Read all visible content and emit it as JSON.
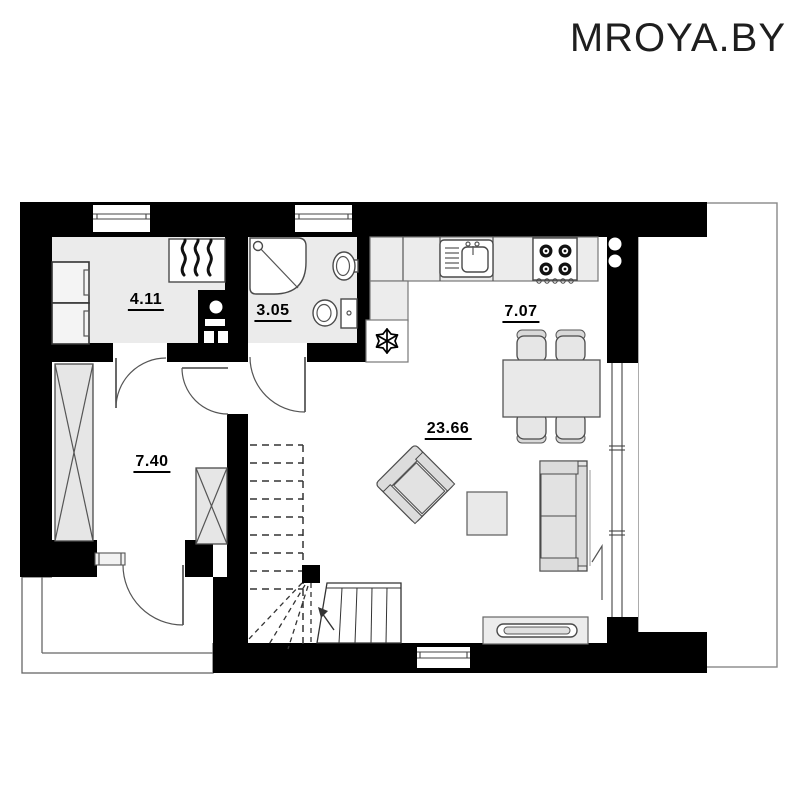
{
  "watermark": {
    "text": "MROYA.BY",
    "color": "#1e1e1e"
  },
  "plan": {
    "colors": {
      "wall": "#000000",
      "room_fill": "#ebebeb",
      "floor": "#ffffff",
      "furniture_fill": "#e6e6e6",
      "furniture_stroke": "#4a4a4a",
      "outline": "#555555"
    },
    "rooms": {
      "utility": {
        "label": "4.11"
      },
      "bathroom": {
        "label": "3.05"
      },
      "hallway": {
        "label": "7.40"
      },
      "kitchen": {
        "label": "7.07"
      },
      "living": {
        "label": "23.66"
      }
    },
    "icons": {
      "boiler": "flame-icon",
      "fridge": "snowflake-icon",
      "stairs_direction": "arrow-up-icon",
      "shower": "shower-cabin-icon",
      "toilet": "toilet-icon",
      "sink": "sink-icon",
      "stove": "four-burner-stove-icon"
    }
  }
}
